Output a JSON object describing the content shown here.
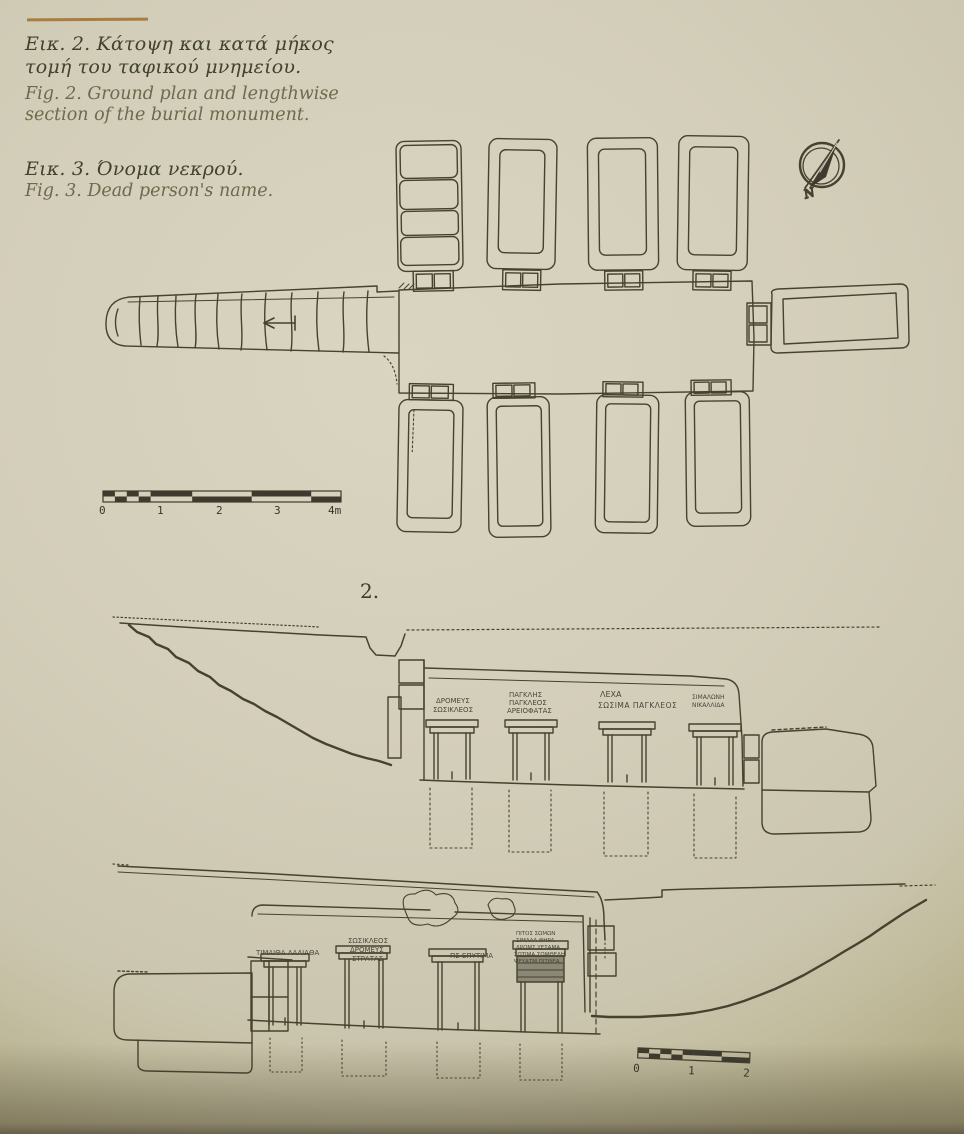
{
  "page": {
    "background_hex": "#d3ceb9",
    "ink_hex": "#403d30",
    "rule_hex": "#a87d42"
  },
  "captions": {
    "fig2_greek_1": "Εικ. 2. Κάτοψη και κατά μήκος",
    "fig2_greek_2": "τομή του ταφικού μνημείου.",
    "fig2_english_1": "Fig. 2. Ground plan and lengthwise",
    "fig2_english_2": "section of the burial monument.",
    "fig3_greek": "Εικ. 3. Όνομα νεκρού.",
    "fig3_english": "Fig. 3. Dead person's name."
  },
  "figure": {
    "number_label": "2.",
    "compass_north_label": "N",
    "plan_scale_labels": [
      "0",
      "1",
      "2",
      "3",
      "4m"
    ],
    "section_scale_labels": [
      "0",
      "1",
      "2"
    ],
    "upper_inscriptions": [
      {
        "lines": [
          "ΔΡΟΜΕΥΣ",
          "ΣΩΣΙΚΛΕΟΣ"
        ]
      },
      {
        "lines": [
          "ΠΑΓΚΛΗΣ",
          "ΠΑΓΚΛΕΟΣ",
          "ΑΡΕΙΟΦΑΤΑΣ"
        ]
      },
      {
        "lines": [
          "ΛΕΧΑ",
          "ΣΩΣΙΜΑ ΠΑΓΚΛΕΟΣ"
        ]
      },
      {
        "lines": [
          "ΣΙΜΑΛΩΝΗ",
          "ΝΙΚΑΛΛΙΔΑ"
        ]
      }
    ],
    "lower_inscriptions": [
      {
        "lines": [
          "ΤΙΜΑΙΘΑ ΛΑΛΙΑΘΑ"
        ]
      },
      {
        "lines": [
          "ΣΩΣΙΚΛΕΟΣ",
          "ΔΡΟΜΕΥΣ",
          "ΣΤΡΑΤΑΣ"
        ]
      },
      {
        "lines": [
          "ΠΣ ΕΠΥΤΙΜΑ"
        ]
      },
      {
        "lines": [
          "ΠΙΤΟΣ ΣΩΜΩΝ",
          "ΣΙΜΑΛΑ ΘΗΡΑ",
          "ΔΡΟΜΣ ΥΕΣΑΜΑ",
          "ΣΩΤΙΜΑ ΣΩΜΘΕΛΗ",
          "ΨΕΥΑΤΜ ΠΙΤΘΕΑ"
        ]
      }
    ]
  }
}
